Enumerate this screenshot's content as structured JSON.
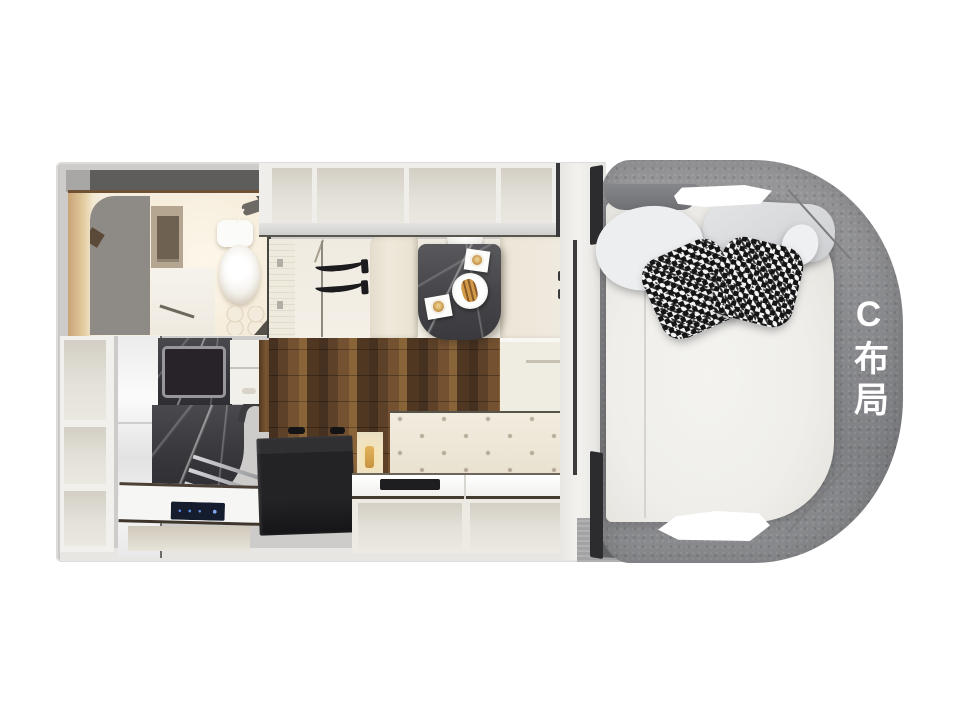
{
  "label": {
    "text": "C布局",
    "color": "#ffffff"
  },
  "palette": {
    "page_background": "#ffffff",
    "shell_gray": "#cdccca",
    "surround_felt_gray": "#8e8f92",
    "mattress_ivory": "#efeeea",
    "cabinet_cream": "#e9e6dd",
    "bench_cream": "#efe9da",
    "wood_walnut": "#5c402a",
    "marble_dark": "#3d3c40",
    "appliance_black": "#1d1d1f",
    "cooktop_glow_blue": "#5b8ce4",
    "warm_light_beige": "#d9b98c",
    "houndstooth_black": "#161616"
  }
}
